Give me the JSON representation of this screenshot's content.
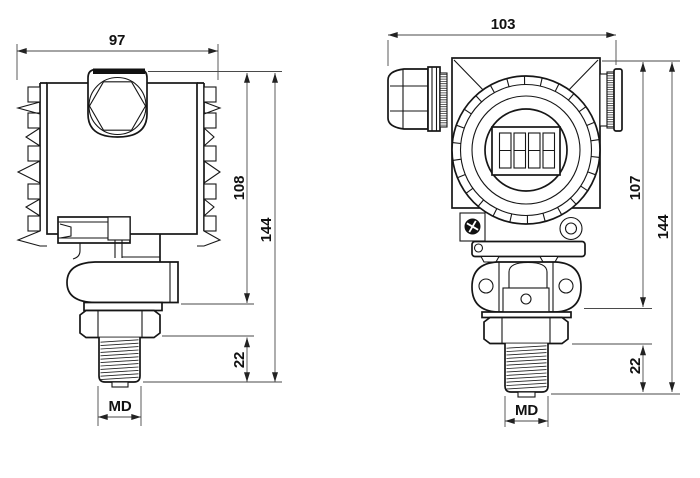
{
  "drawing": {
    "title": "pressure transmitter dimensional drawing",
    "colors": {
      "line": "#161616",
      "dim_line": "#4a4a4a",
      "background": "#ffffff"
    },
    "side_view": {
      "name": "side view",
      "width": "97",
      "housing_height": "108",
      "overall_height": "144",
      "thread_length": "22",
      "thread_label": "MD"
    },
    "front_view": {
      "name": "front view",
      "width": "103",
      "housing_height": "107",
      "overall_height": "144",
      "thread_length": "22",
      "thread_label": "MD"
    }
  }
}
